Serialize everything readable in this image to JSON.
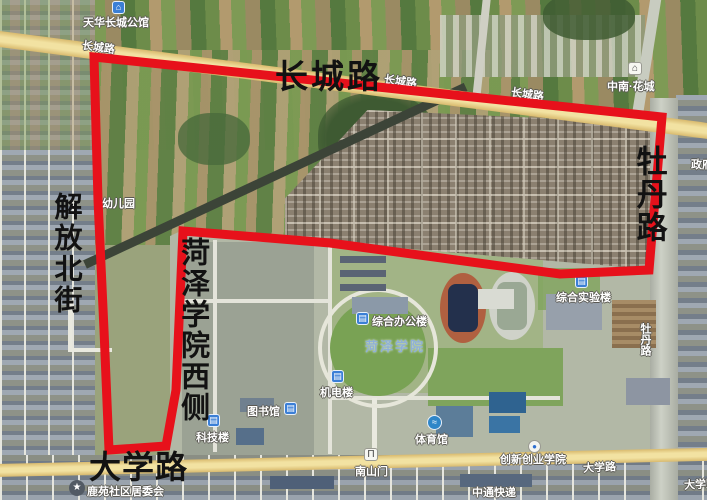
{
  "map": {
    "type": "satellite-map-with-boundary",
    "boundary_color": "#e7111b",
    "main_road_color": "#f0dc9a",
    "big_labels": {
      "changcheng": "长城路",
      "mudan": "牡丹路",
      "jiefang": "解放北街",
      "college_west": "菏泽学院西侧",
      "daxue": "大学路"
    },
    "road_tags": {
      "changcheng_1": "长城路",
      "changcheng_2": "长城路",
      "changcheng_3": "长城路",
      "daxue_1": "大学路",
      "daxue_2": "大学路",
      "mudan_road": "牡丹路",
      "edge_partial": "政府"
    },
    "pois": {
      "tianhua": "天华长城公馆",
      "zhongnan": "中南·花城",
      "kindergarten": "幼儿园",
      "lab_building": "综合实验楼",
      "office_building": "综合办公楼",
      "campus_name": "菏泽学院",
      "jidian_building": "机电楼",
      "library": "图书馆",
      "keji_building": "科技楼",
      "gym": "体育馆",
      "innovation_college": "创新创业学院",
      "south_gate": "南山门",
      "zto_express": "中通快递",
      "community": "鹿苑社区居委会"
    },
    "icons": {
      "house": "⌂",
      "building": "▤",
      "book": "▤",
      "star": "★",
      "gate": "Π",
      "swim": "≈",
      "pin": "●"
    }
  }
}
